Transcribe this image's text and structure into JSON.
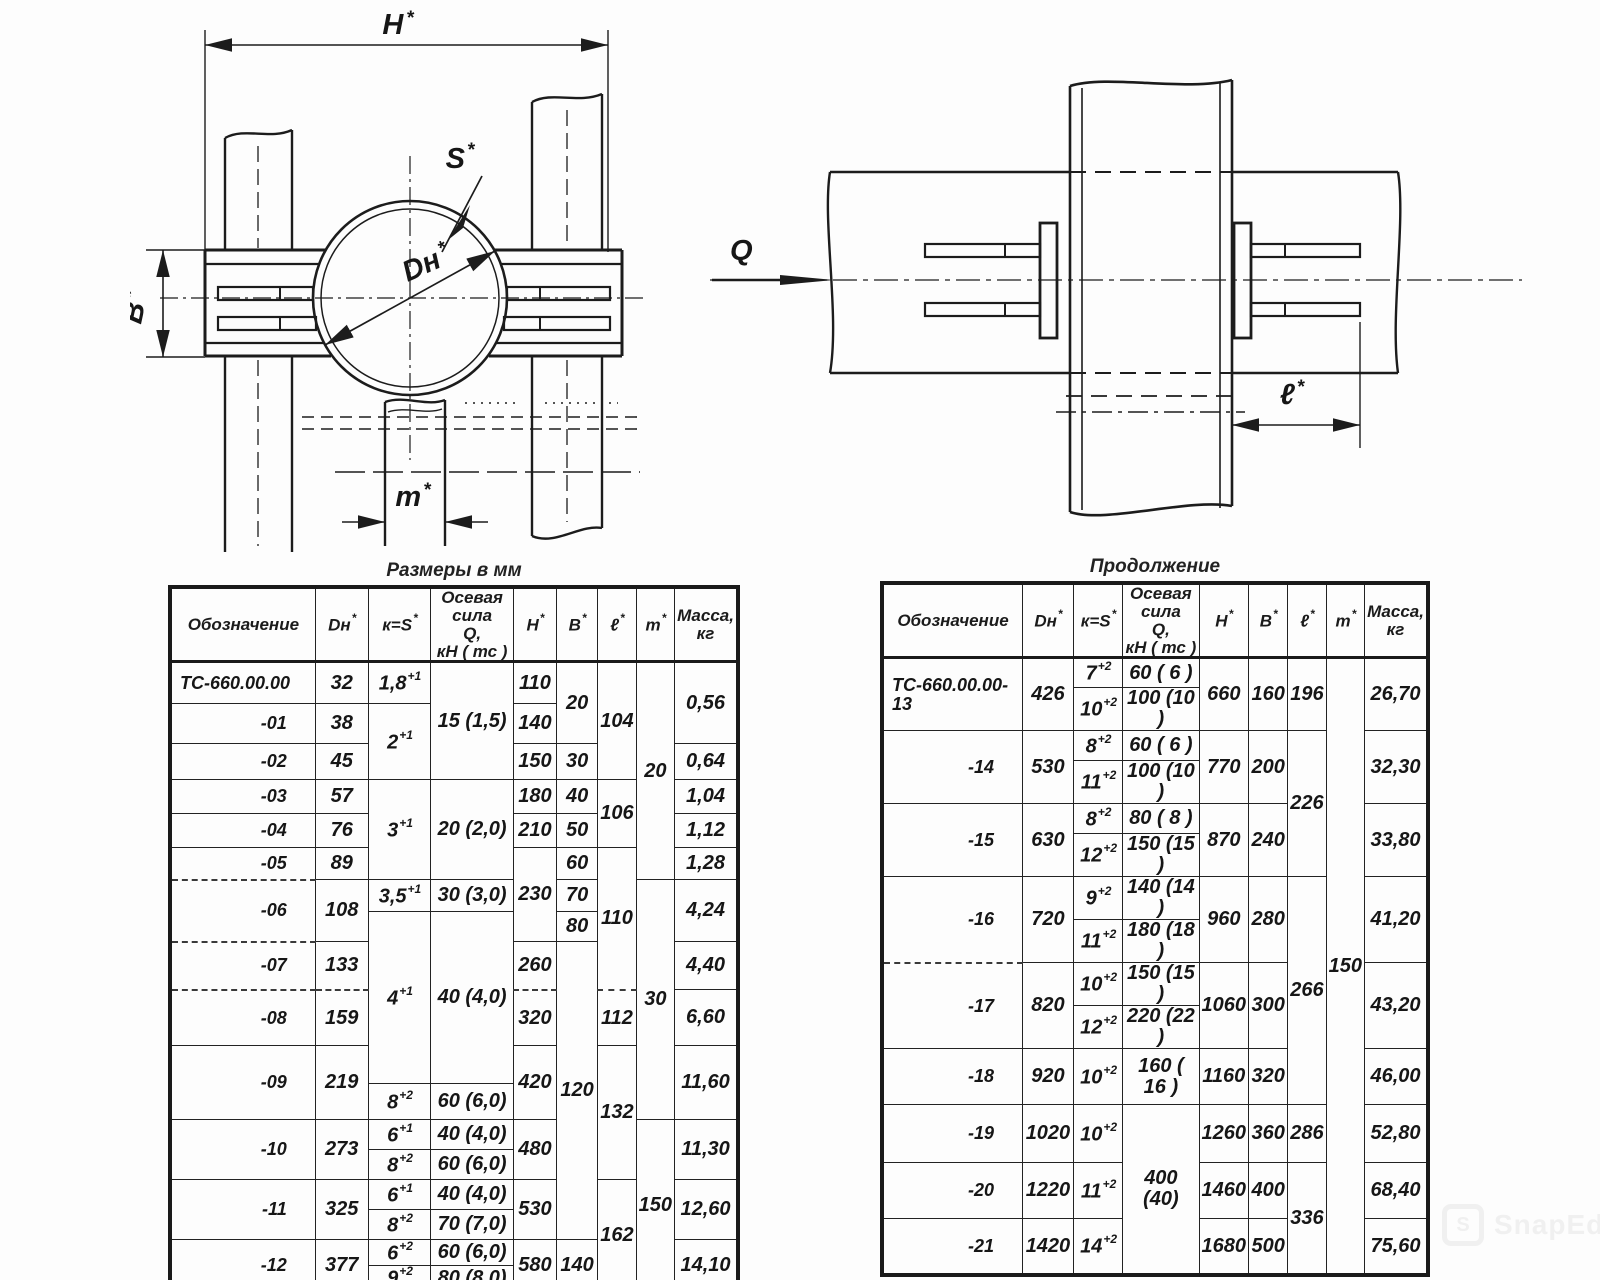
{
  "page": {
    "background": "#fdfdfd",
    "ink": "#1c1c1c"
  },
  "drawing_front": {
    "labels": {
      "h": "H",
      "b": "B",
      "s": "S",
      "dn": "Dн",
      "m": "m",
      "star": "*"
    }
  },
  "drawing_side": {
    "labels": {
      "q": "Q",
      "l": "ℓ",
      "star": "*"
    }
  },
  "tables": {
    "left": {
      "title": "Размеры в мм",
      "col_widths": [
        150,
        56,
        66,
        86,
        44,
        42,
        38,
        38,
        52
      ],
      "header_height": 66,
      "row_heights": [
        42,
        40,
        36,
        34,
        34,
        32,
        32,
        30,
        48,
        56,
        38,
        36,
        30,
        30,
        30,
        30,
        26,
        26
      ],
      "headers": [
        {
          "t": "Обозначение"
        },
        {
          "t": "Dн",
          "sup": "*"
        },
        {
          "t": "к=S",
          "sup": "*"
        },
        {
          "t": "Осевая\nсила\nQ,\nкН ( тс )"
        },
        {
          "t": "H",
          "sup": "*"
        },
        {
          "t": "B",
          "sup": "*"
        },
        {
          "t": "ℓ",
          "sup": "*"
        },
        {
          "t": "m",
          "sup": "*"
        },
        {
          "t": "Масса,\nкг"
        }
      ],
      "rows": [
        [
          {
            "t": "ТС-660.00.00",
            "al": "l"
          },
          {
            "t": "32"
          },
          {
            "t": "1,8",
            "sup": "+1"
          },
          {
            "t": "15 (1,5)",
            "rs": 3
          },
          {
            "t": "110"
          },
          {
            "t": "20",
            "rs": 2
          },
          {
            "t": "104",
            "rs": 3
          },
          {
            "t": "20",
            "rs": 6
          },
          {
            "t": "0,56",
            "rs": 2
          }
        ],
        [
          {
            "t": "-01",
            "al": "r"
          },
          {
            "t": "38"
          },
          {
            "t": "2",
            "sup": "+1",
            "rs": 2
          },
          {
            "t": "140"
          }
        ],
        [
          {
            "t": "-02",
            "al": "r"
          },
          {
            "t": "45"
          },
          {
            "t": "150"
          },
          {
            "t": "30"
          },
          {
            "t": "0,64"
          }
        ],
        [
          {
            "t": "-03",
            "al": "r"
          },
          {
            "t": "57"
          },
          {
            "t": "3",
            "sup": "+1",
            "rs": 3
          },
          {
            "t": "20 (2,0)",
            "rs": 3
          },
          {
            "t": "180"
          },
          {
            "t": "40"
          },
          {
            "t": "106",
            "rs": 2
          },
          {
            "t": "1,04"
          }
        ],
        [
          {
            "t": "-04",
            "al": "r"
          },
          {
            "t": "76"
          },
          {
            "t": "210"
          },
          {
            "t": "50"
          },
          {
            "t": "1,12"
          }
        ],
        [
          {
            "t": "-05",
            "al": "r"
          },
          {
            "t": "89"
          },
          {
            "t": "230",
            "rs": 3
          },
          {
            "t": "60"
          },
          {
            "t": "110",
            "rs": 4
          },
          {
            "t": "1,28"
          }
        ],
        [
          {
            "t": "-06",
            "al": "r",
            "rs": 2,
            "d": 1
          },
          {
            "t": "108",
            "rs": 2
          },
          {
            "t": "3,5",
            "sup": "+1"
          },
          {
            "t": "30 (3,0)"
          },
          {
            "t": "70"
          },
          {
            "t": "30",
            "rs": 6
          },
          {
            "t": "4,24",
            "rs": 2
          }
        ],
        [
          {
            "t": "4",
            "sup": "+1",
            "rs": 4
          },
          {
            "t": "40 (4,0)",
            "rs": 4
          },
          {
            "t": "80"
          }
        ],
        [
          {
            "t": "-07",
            "al": "r",
            "d": 1
          },
          {
            "t": "133"
          },
          {
            "t": "260"
          },
          {
            "t": "120",
            "rs": 8
          },
          {
            "t": "4,40"
          }
        ],
        [
          {
            "t": "-08",
            "al": "r",
            "d": 1
          },
          {
            "t": "159",
            "d": 1
          },
          {
            "t": "320",
            "d": 1
          },
          {
            "t": "112",
            "d": 1
          },
          {
            "t": "6,60"
          }
        ],
        [
          {
            "t": "-09",
            "al": "r",
            "rs": 2
          },
          {
            "t": "219",
            "rs": 2
          },
          {
            "t": "420",
            "rs": 2
          },
          {
            "t": "132",
            "rs": 4
          },
          {
            "t": "11,60",
            "rs": 2
          }
        ],
        [
          {
            "t": "8",
            "sup": "+2"
          },
          {
            "t": "60 (6,0)"
          }
        ],
        [
          {
            "t": "-10",
            "al": "r",
            "rs": 2
          },
          {
            "t": "273",
            "rs": 2
          },
          {
            "t": "6",
            "sup": "+1"
          },
          {
            "t": "40 (4,0)"
          },
          {
            "t": "480",
            "rs": 2
          },
          {
            "t": "150",
            "rs": 6
          },
          {
            "t": "11,30",
            "rs": 2
          }
        ],
        [
          {
            "t": "8",
            "sup": "+2"
          },
          {
            "t": "60 (6,0)"
          }
        ],
        [
          {
            "t": "-11",
            "al": "r",
            "rs": 2
          },
          {
            "t": "325",
            "rs": 2
          },
          {
            "t": "6",
            "sup": "+1"
          },
          {
            "t": "40 (4,0)"
          },
          {
            "t": "530",
            "rs": 2
          },
          {
            "t": "162",
            "rs": 4
          },
          {
            "t": "12,60",
            "rs": 2
          }
        ],
        [
          {
            "t": "8",
            "sup": "+2"
          },
          {
            "t": "70 (7,0)"
          }
        ],
        [
          {
            "t": "-12",
            "al": "r",
            "rs": 2
          },
          {
            "t": "377",
            "rs": 2
          },
          {
            "t": "6",
            "sup": "+2"
          },
          {
            "t": "60 (6,0)"
          },
          {
            "t": "580",
            "rs": 2
          },
          {
            "t": "140",
            "rs": 2
          },
          {
            "t": "14,10",
            "rs": 2
          }
        ],
        [
          {
            "t": "9",
            "sup": "+2"
          },
          {
            "t": "80 (8,0)"
          }
        ]
      ]
    },
    "right": {
      "title": "Продолжение",
      "col_widths": [
        150,
        52,
        56,
        84,
        42,
        40,
        38,
        36,
        52
      ],
      "header_height": 66,
      "row_heights": [
        30,
        30,
        30,
        30,
        30,
        30,
        28,
        28,
        28,
        28,
        56,
        58,
        56,
        56
      ],
      "headers": [
        {
          "t": "Обозначение"
        },
        {
          "t": "Dн",
          "sup": "*"
        },
        {
          "t": "к=S",
          "sup": "*"
        },
        {
          "t": "Осевая\nсила\nQ,\nкН ( тс )"
        },
        {
          "t": "H",
          "sup": "*"
        },
        {
          "t": "B",
          "sup": "*"
        },
        {
          "t": "ℓ",
          "sup": "*"
        },
        {
          "t": "m",
          "sup": "*"
        },
        {
          "t": "Масса,\nкг"
        }
      ],
      "rows": [
        [
          {
            "t": "ТС-660.00.00-13",
            "al": "l",
            "rs": 2
          },
          {
            "t": "426",
            "rs": 2
          },
          {
            "t": "7",
            "sup": "+2"
          },
          {
            "t": "60 ( 6 )"
          },
          {
            "t": "660",
            "rs": 2
          },
          {
            "t": "160",
            "rs": 2
          },
          {
            "t": "196",
            "rs": 2
          },
          {
            "t": "150",
            "rs": 14
          },
          {
            "t": "26,70",
            "rs": 2
          }
        ],
        [
          {
            "t": "10",
            "sup": "+2"
          },
          {
            "t": "100 (10 )"
          }
        ],
        [
          {
            "t": "-14",
            "al": "r",
            "rs": 2
          },
          {
            "t": "530",
            "rs": 2
          },
          {
            "t": "8",
            "sup": "+2"
          },
          {
            "t": "60 ( 6 )"
          },
          {
            "t": "770",
            "rs": 2
          },
          {
            "t": "200",
            "rs": 2
          },
          {
            "t": "226",
            "rs": 4
          },
          {
            "t": "32,30",
            "rs": 2
          }
        ],
        [
          {
            "t": "11",
            "sup": "+2"
          },
          {
            "t": "100 (10 )"
          }
        ],
        [
          {
            "t": "-15",
            "al": "r",
            "rs": 2
          },
          {
            "t": "630",
            "rs": 2
          },
          {
            "t": "8",
            "sup": "+2"
          },
          {
            "t": "80 ( 8 )"
          },
          {
            "t": "870",
            "rs": 2
          },
          {
            "t": "240",
            "rs": 2
          },
          {
            "t": "33,80",
            "rs": 2
          }
        ],
        [
          {
            "t": "12",
            "sup": "+2"
          },
          {
            "t": "150 (15 )"
          }
        ],
        [
          {
            "t": "-16",
            "al": "r",
            "rs": 2
          },
          {
            "t": "720",
            "rs": 2
          },
          {
            "t": "9",
            "sup": "+2"
          },
          {
            "t": "140 (14 )"
          },
          {
            "t": "960",
            "rs": 2
          },
          {
            "t": "280",
            "rs": 2
          },
          {
            "t": "266",
            "rs": 5
          },
          {
            "t": "41,20",
            "rs": 2
          }
        ],
        [
          {
            "t": "11",
            "sup": "+2"
          },
          {
            "t": "180 (18 )"
          }
        ],
        [
          {
            "t": "-17",
            "al": "r",
            "rs": 2,
            "d": 1
          },
          {
            "t": "820",
            "rs": 2
          },
          {
            "t": "10",
            "sup": "+2"
          },
          {
            "t": "150 (15 )"
          },
          {
            "t": "1060",
            "rs": 2
          },
          {
            "t": "300",
            "rs": 2
          },
          {
            "t": "43,20",
            "rs": 2
          }
        ],
        [
          {
            "t": "12",
            "sup": "+2"
          },
          {
            "t": "220 (22 )"
          }
        ],
        [
          {
            "t": "-18",
            "al": "r"
          },
          {
            "t": "920"
          },
          {
            "t": "10",
            "sup": "+2"
          },
          {
            "t": "160 ( 16 )"
          },
          {
            "t": "1160"
          },
          {
            "t": "320"
          },
          {
            "t": "46,00"
          }
        ],
        [
          {
            "t": "-19",
            "al": "r"
          },
          {
            "t": "1020"
          },
          {
            "t": "10",
            "sup": "+2"
          },
          {
            "t": "400 (40)",
            "rs": 3
          },
          {
            "t": "1260"
          },
          {
            "t": "360"
          },
          {
            "t": "286"
          },
          {
            "t": "52,80"
          }
        ],
        [
          {
            "t": "-20",
            "al": "r"
          },
          {
            "t": "1220"
          },
          {
            "t": "11",
            "sup": "+2"
          },
          {
            "t": "1460"
          },
          {
            "t": "400"
          },
          {
            "t": "336",
            "rs": 2
          },
          {
            "t": "68,40"
          }
        ],
        [
          {
            "t": "-21",
            "al": "r"
          },
          {
            "t": "1420"
          },
          {
            "t": "14",
            "sup": "+2"
          },
          {
            "t": "1680"
          },
          {
            "t": "500"
          },
          {
            "t": "75,60"
          }
        ]
      ]
    }
  },
  "watermark": {
    "icon_letter": "S",
    "text": "SnapEdit"
  }
}
